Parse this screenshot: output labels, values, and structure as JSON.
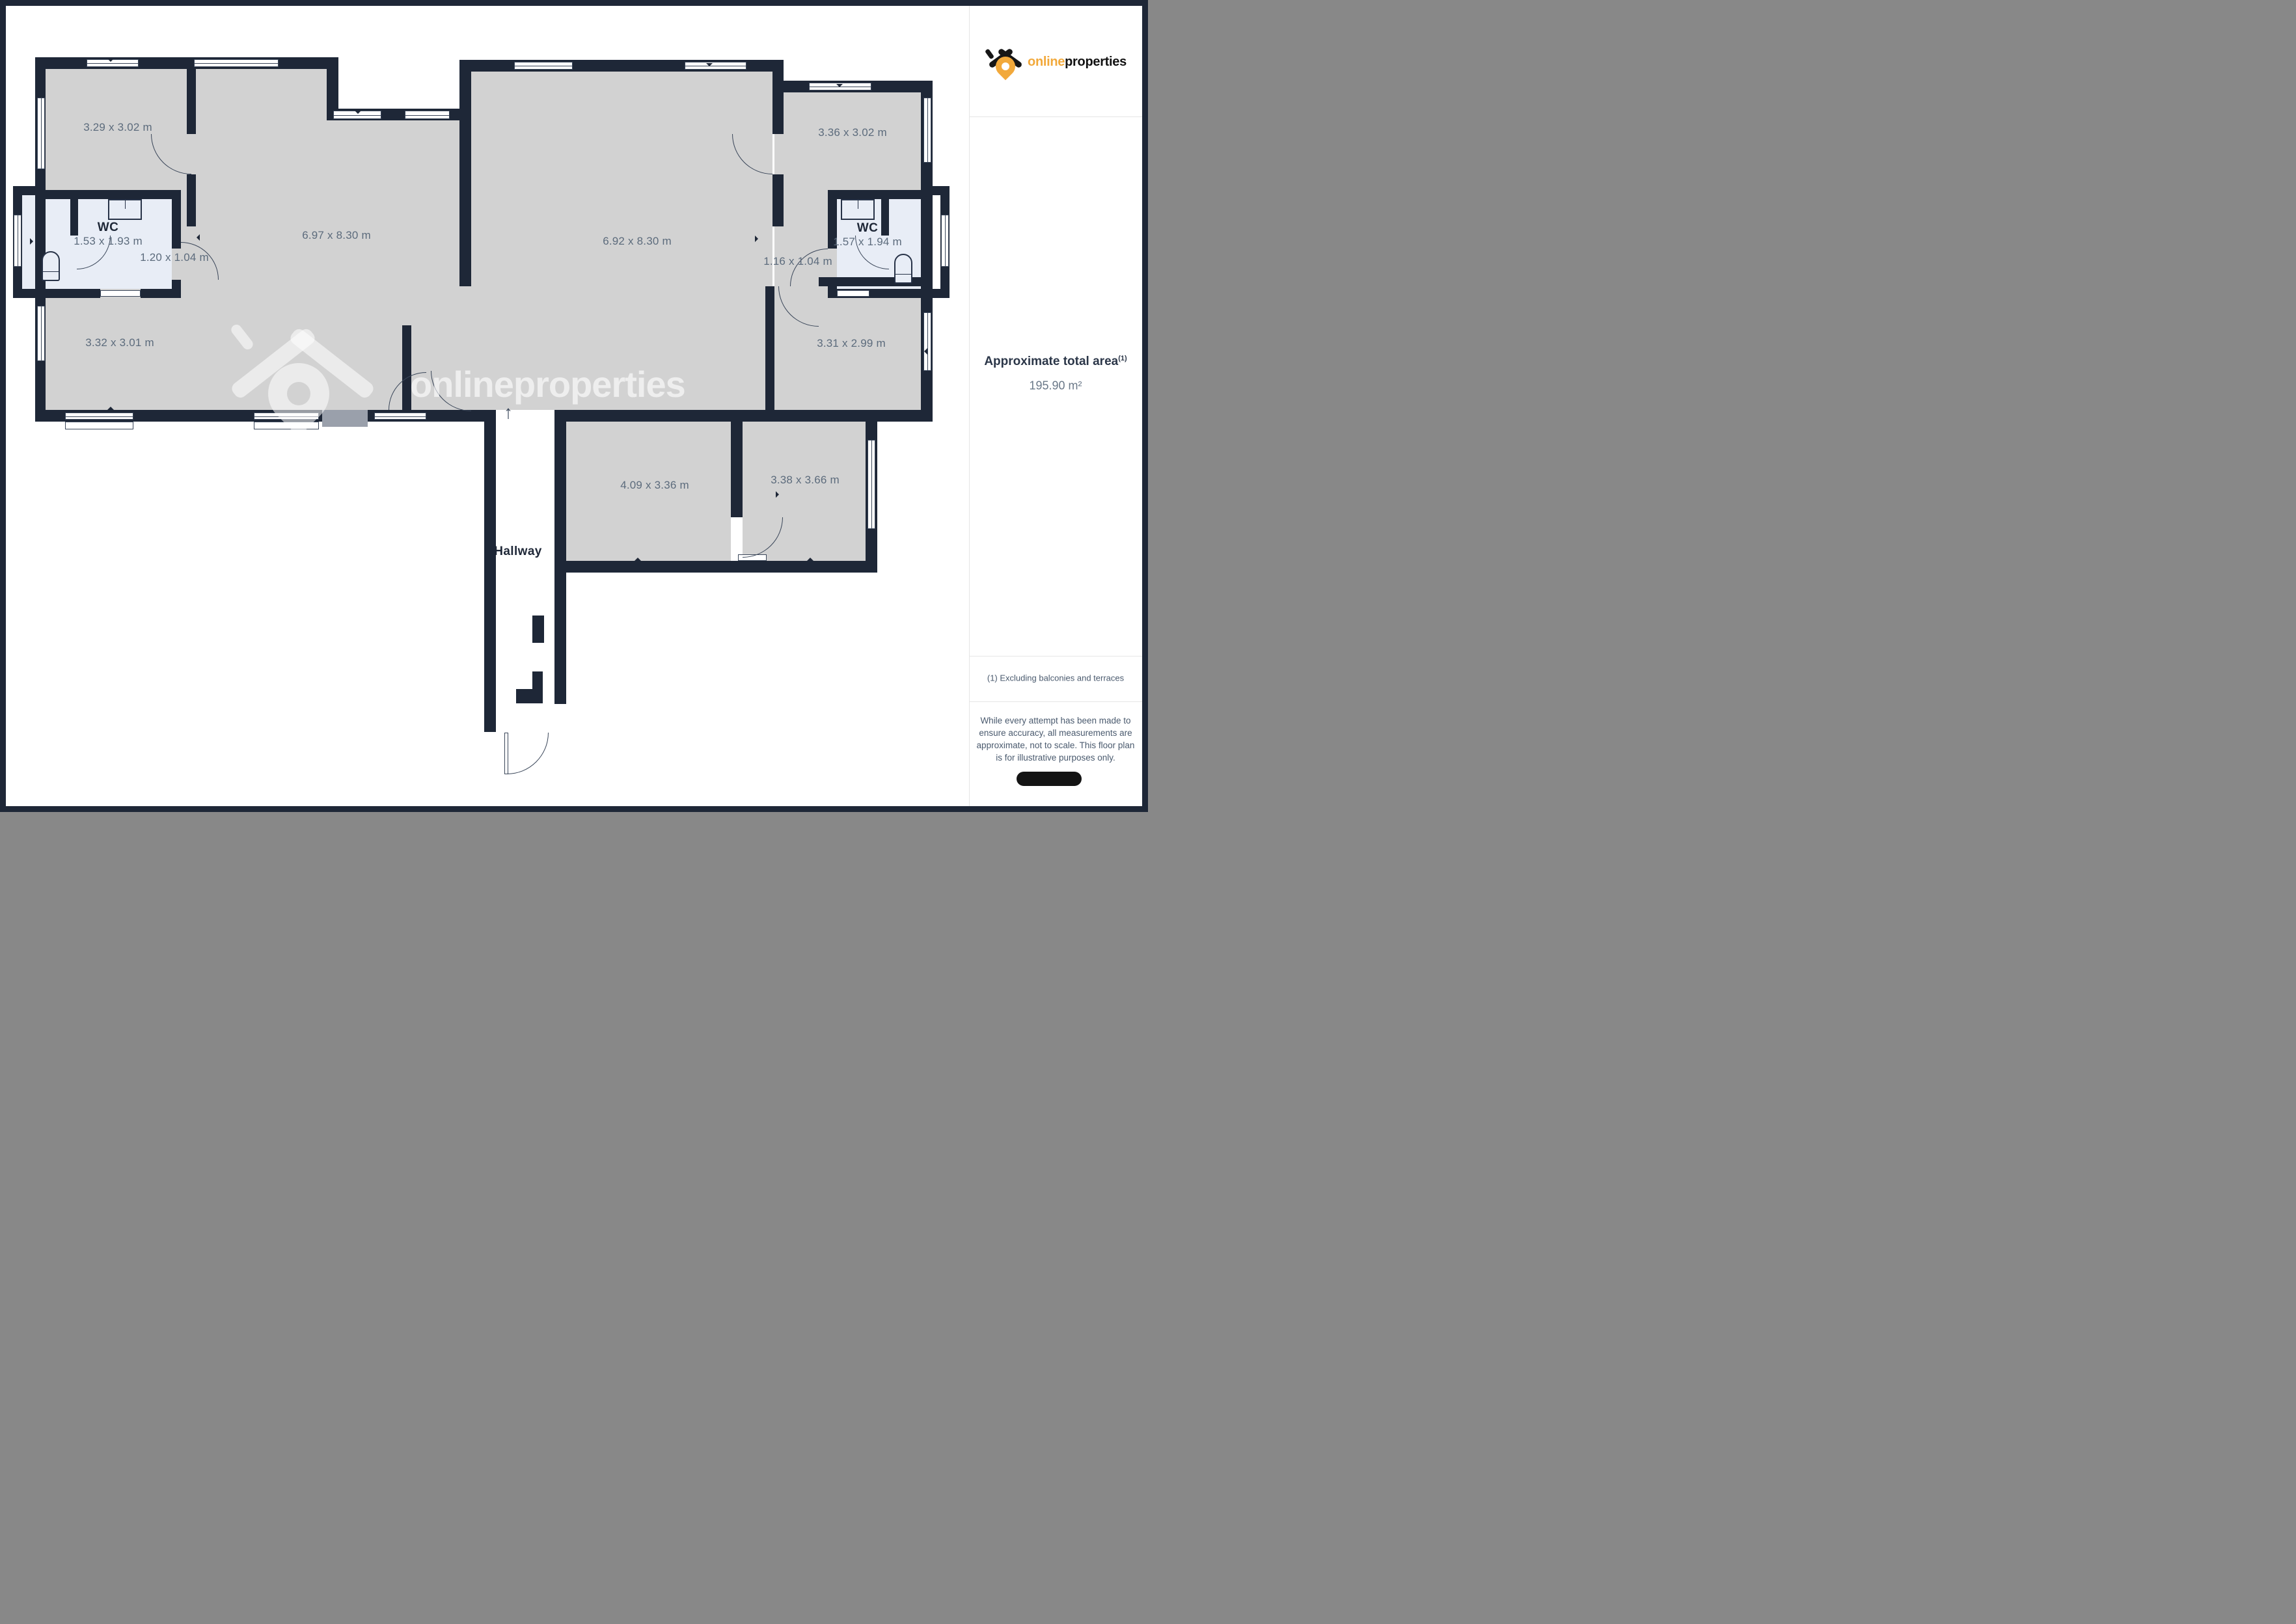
{
  "sidebar": {
    "logo": {
      "online": "online",
      "properties": "properties"
    },
    "area_title": "Approximate total area",
    "area_sup": "(1)",
    "area_value": "195.90 m²",
    "footnote": "(1) Excluding balconies and terraces",
    "disclaimer": "While every attempt has been made to ensure accuracy, all measurements are approximate, not to scale. This floor plan is for illustrative purposes only."
  },
  "plan": {
    "watermark_brand": "onlineproperties",
    "north_arrow_glyph": "↑",
    "colors": {
      "wall": "#1E2737",
      "floor": "#D2D2D2",
      "wet_floor": "#E8EDF6",
      "dimension_text": "#5C6B7C",
      "brand_orange": "#F2A93B"
    },
    "rooms": [
      {
        "id": "room-top-left",
        "dims": "3.29 x 3.02 m"
      },
      {
        "id": "room-top-right",
        "dims": "3.36 x 3.02 m"
      },
      {
        "id": "wc-left",
        "label": "WC",
        "dims": "1.53 x 1.93 m"
      },
      {
        "id": "lobby-left",
        "dims": "1.20 x 1.04 m"
      },
      {
        "id": "living-left",
        "dims": "6.97 x 8.30 m"
      },
      {
        "id": "living-right",
        "dims": "6.92 x 8.30 m"
      },
      {
        "id": "wc-right",
        "label": "WC",
        "dims": "1.57 x 1.94 m"
      },
      {
        "id": "lobby-right",
        "dims": "1.16 x 1.04 m"
      },
      {
        "id": "room-bottom-left",
        "dims": "3.32 x 3.01 m"
      },
      {
        "id": "room-bottom-right",
        "dims": "3.31 x 2.99 m"
      },
      {
        "id": "room-bottom-center",
        "dims": "4.09 x 3.36 m"
      },
      {
        "id": "room-bottom-center-right",
        "dims": "3.38 x 3.66 m"
      },
      {
        "id": "hallway",
        "label": "Hallway"
      }
    ]
  }
}
